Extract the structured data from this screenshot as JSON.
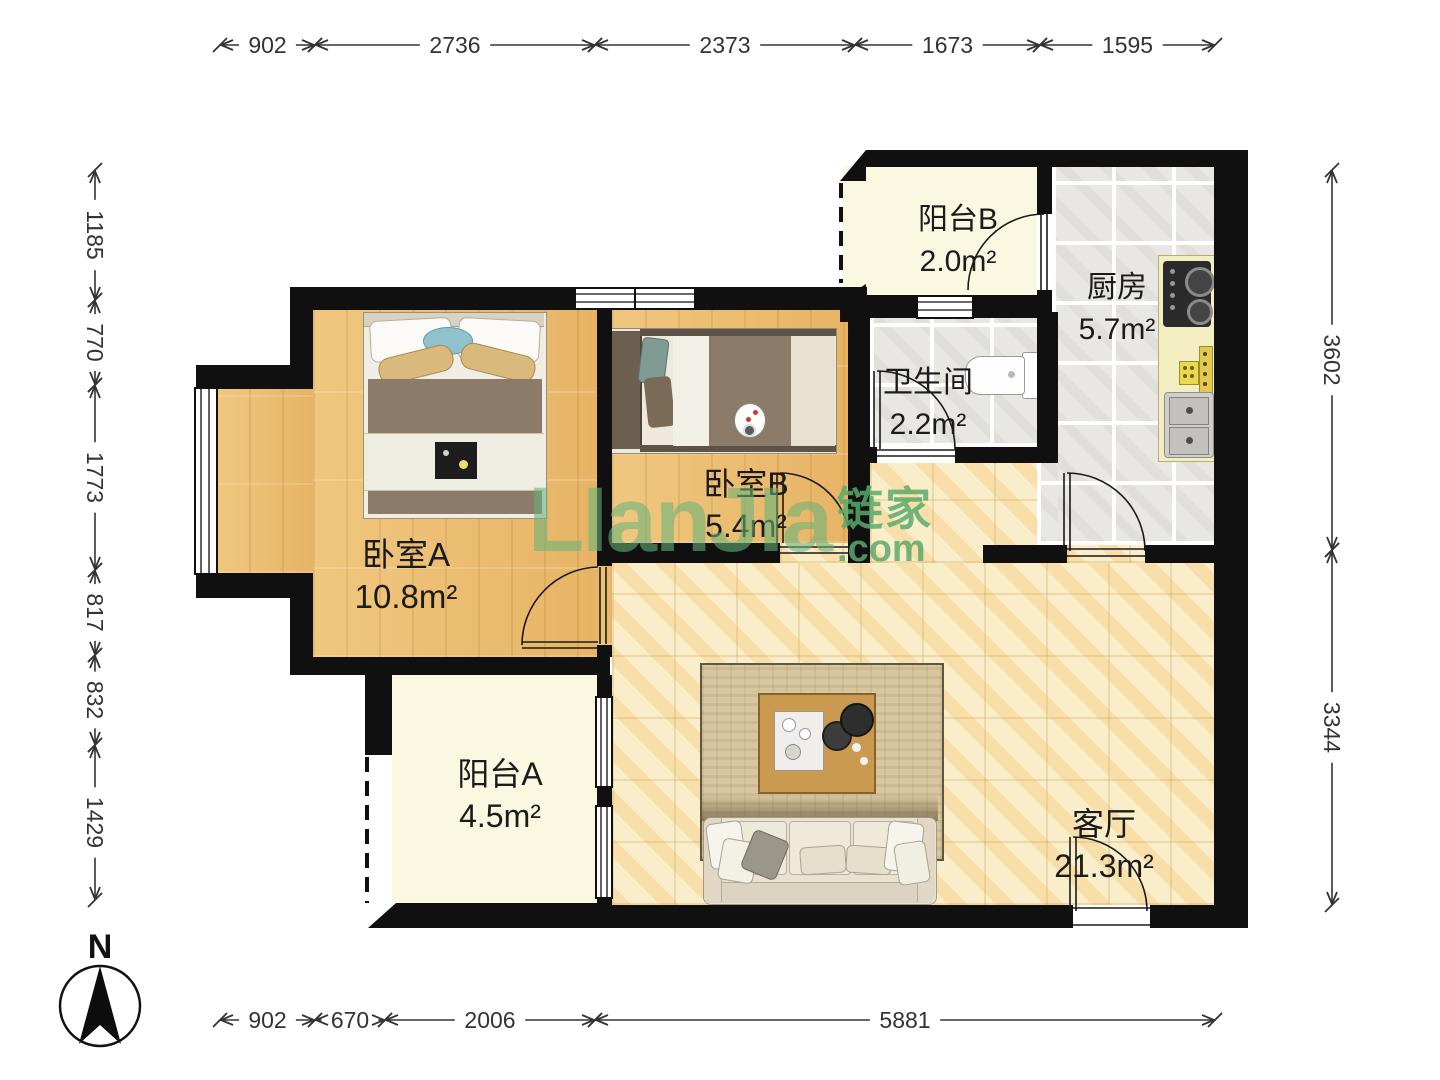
{
  "watermark": {
    "logo": "LIanJIa",
    "cn": "链家",
    "suffix": ".com"
  },
  "compass": {
    "label": "N"
  },
  "rooms": [
    {
      "id": "bedroom-a",
      "name": "卧室A",
      "area": "10.8m²"
    },
    {
      "id": "bedroom-b",
      "name": "卧室B",
      "area": "5.4m²"
    },
    {
      "id": "balcony-a",
      "name": "阳台A",
      "area": "4.5m²"
    },
    {
      "id": "balcony-b",
      "name": "阳台B",
      "area": "2.0m²"
    },
    {
      "id": "kitchen",
      "name": "厨房",
      "area": "5.7m²"
    },
    {
      "id": "bathroom",
      "name": "卫生间",
      "area": "2.2m²"
    },
    {
      "id": "living",
      "name": "客厅",
      "area": "21.3m²"
    }
  ],
  "dimensions": {
    "top": {
      "orientation": "horizontal",
      "line": 45,
      "segments": [
        {
          "value": "902",
          "from": 220,
          "to": 315
        },
        {
          "value": "2736",
          "from": 315,
          "to": 595
        },
        {
          "value": "2373",
          "from": 595,
          "to": 855
        },
        {
          "value": "1673",
          "from": 855,
          "to": 1040
        },
        {
          "value": "1595",
          "from": 1040,
          "to": 1215
        }
      ]
    },
    "bottom": {
      "orientation": "horizontal",
      "line": 1020,
      "segments": [
        {
          "value": "902",
          "from": 220,
          "to": 315
        },
        {
          "value": "670",
          "from": 315,
          "to": 385
        },
        {
          "value": "2006",
          "from": 385,
          "to": 595
        },
        {
          "value": "5881",
          "from": 595,
          "to": 1215
        }
      ]
    },
    "left": {
      "orientation": "vertical",
      "line": 95,
      "segments": [
        {
          "value": "1185",
          "from": 170,
          "to": 300
        },
        {
          "value": "770",
          "from": 300,
          "to": 385
        },
        {
          "value": "1773",
          "from": 385,
          "to": 570
        },
        {
          "value": "817",
          "from": 570,
          "to": 655
        },
        {
          "value": "832",
          "from": 655,
          "to": 745
        },
        {
          "value": "1429",
          "from": 745,
          "to": 900
        }
      ]
    },
    "right": {
      "orientation": "vertical",
      "line": 1332,
      "segments": [
        {
          "value": "3602",
          "from": 170,
          "to": 550
        },
        {
          "value": "3344",
          "from": 550,
          "to": 905
        }
      ]
    }
  },
  "colors": {
    "wall": "#101010",
    "wood_floor": "#ecbd72",
    "marble_floor": "#f8e8bd",
    "tile_floor": "#e8e7e4",
    "balcony_floor": "#fbf8e1",
    "watermark_green": "#68b47a"
  }
}
